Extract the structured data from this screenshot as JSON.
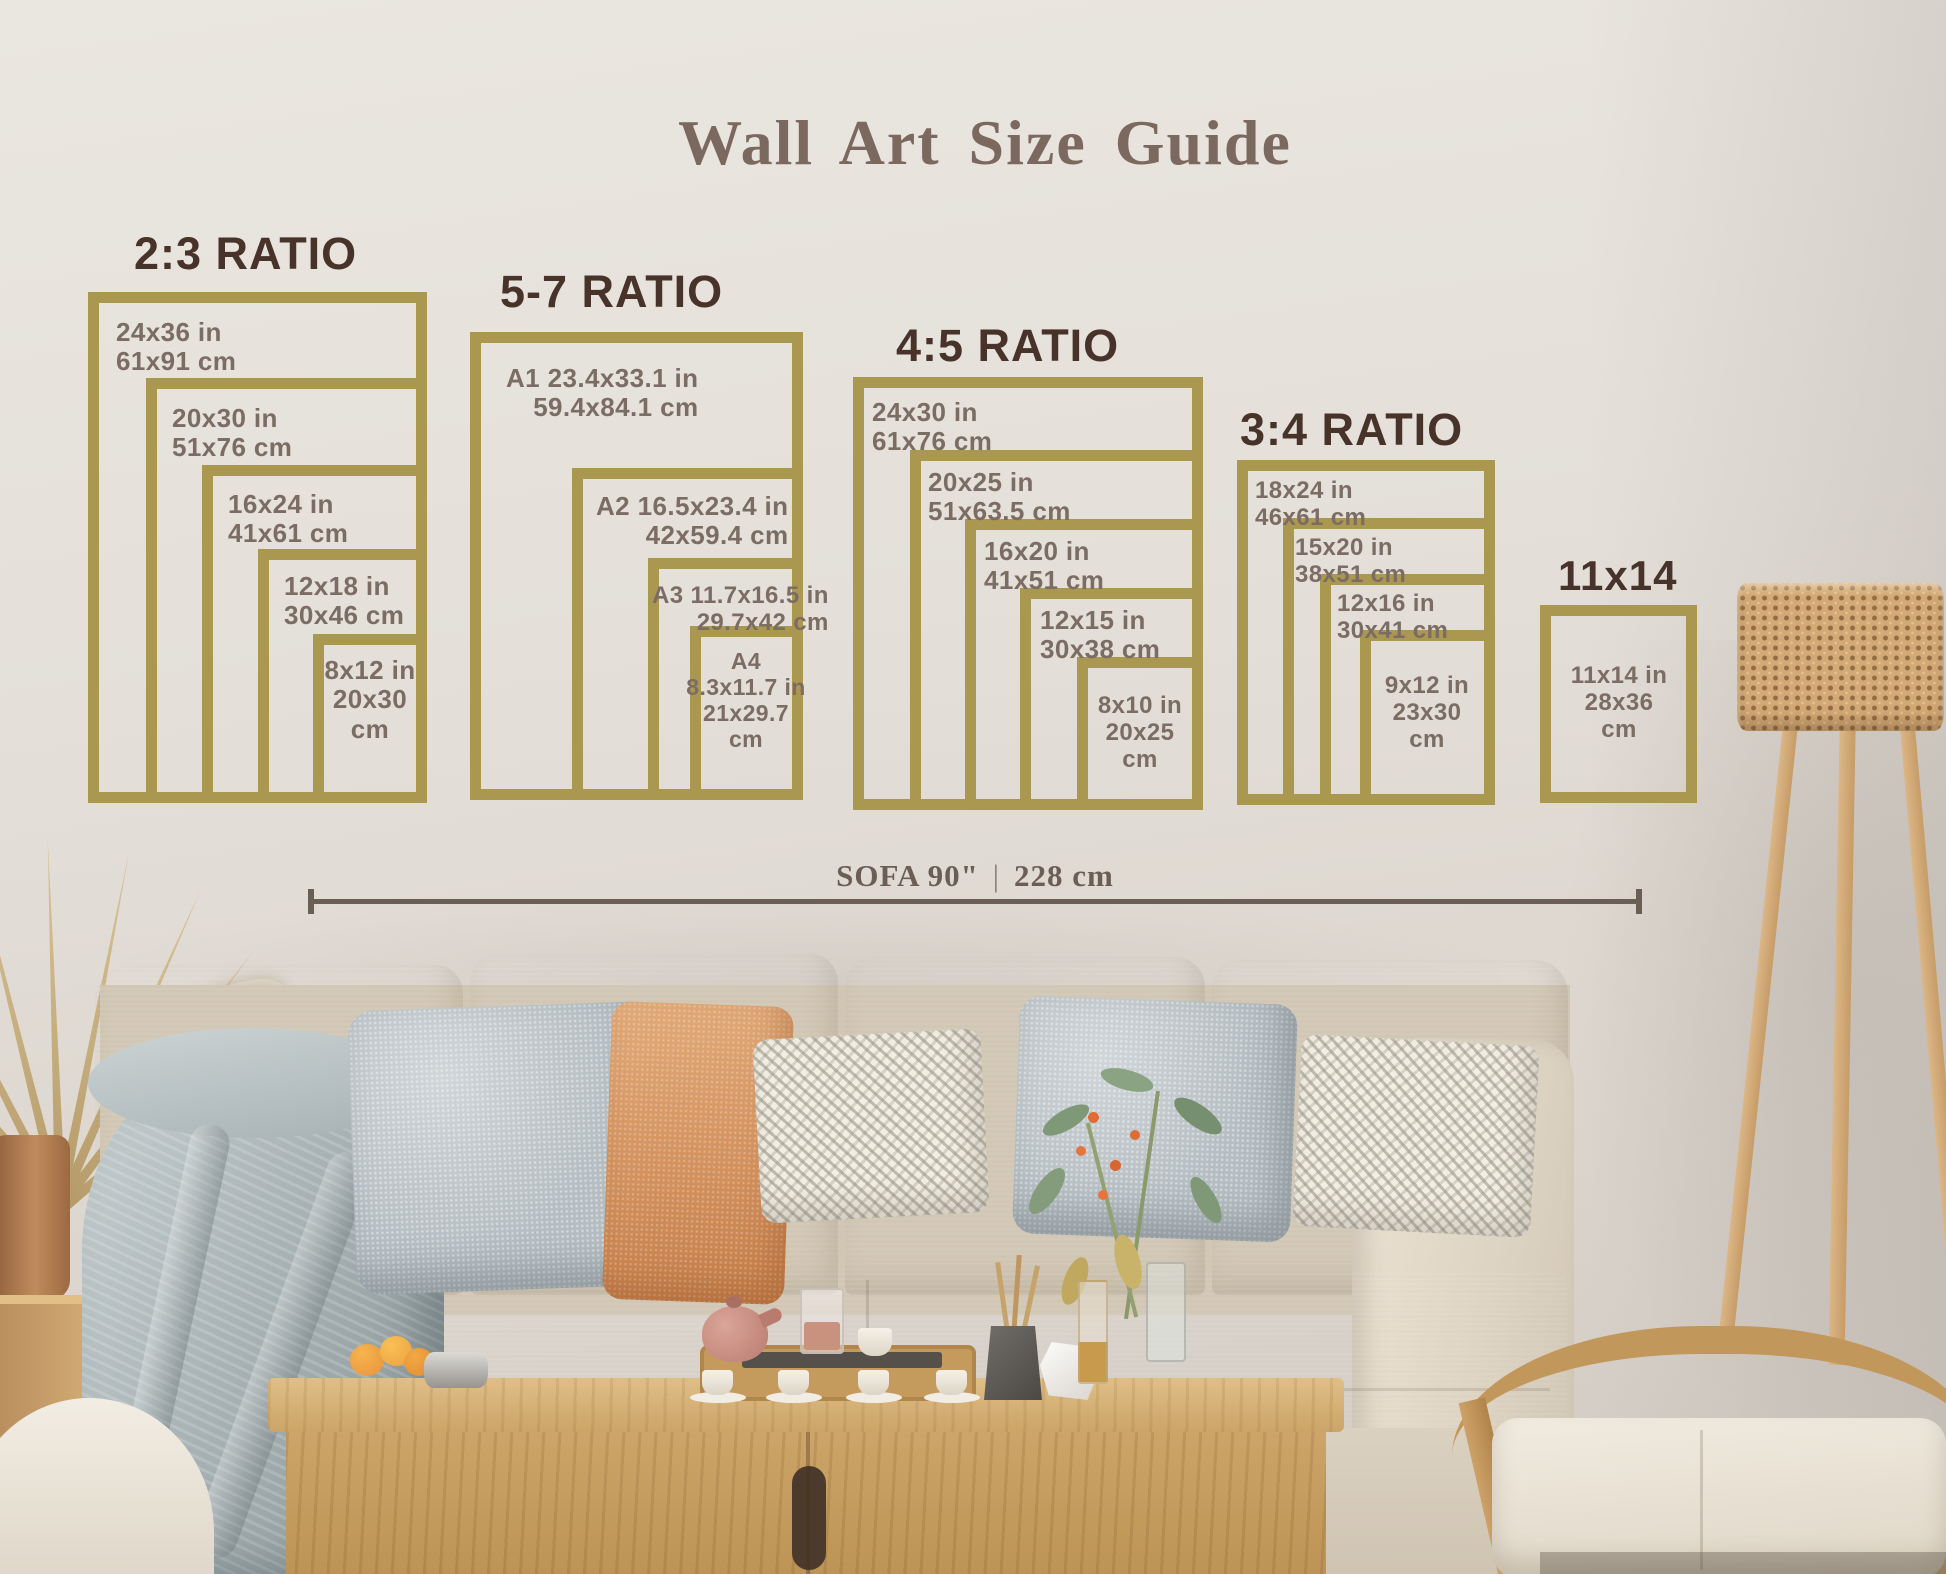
{
  "title": "Wall Art Size Guide",
  "sections": [
    {
      "heading": "2:3 RATIO",
      "sizes": [
        "24x36 in\n61x91 cm",
        "20x30 in\n51x76 cm",
        "16x24 in\n41x61 cm",
        "12x18 in\n30x46 cm",
        "8x12 in\n20x30\ncm"
      ]
    },
    {
      "heading": "5-7 RATIO",
      "sizes": [
        "A1 23.4x33.1 in\n59.4x84.1 cm",
        "A2 16.5x23.4 in\n42x59.4 cm",
        "A3 11.7x16.5 in\n29.7x42 cm",
        "A4\n8.3x11.7 in\n21x29.7\ncm"
      ]
    },
    {
      "heading": "4:5 RATIO",
      "sizes": [
        "24x30 in\n61x76 cm",
        "20x25 in\n51x63.5 cm",
        "16x20 in\n41x51 cm",
        "12x15 in\n30x38 cm",
        "8x10 in\n20x25\ncm"
      ]
    },
    {
      "heading": "3:4 RATIO",
      "sizes": [
        "18x24 in\n46x61 cm",
        "15x20 in\n38x51 cm",
        "12x16 in\n30x41 cm",
        "9x12 in\n23x30\ncm"
      ]
    },
    {
      "heading": "11x14",
      "sizes": [
        "11x14 in\n28x36\ncm"
      ]
    }
  ],
  "measure": {
    "left": "SOFA 90\"",
    "separator": "|",
    "right": "228 cm"
  },
  "colors": {
    "frame_gold": "#ab9850",
    "heading_brown": "#48332a",
    "label_gray": "#7b6d63",
    "title_brown": "#7b685e",
    "measure_taupe": "#6b5e55",
    "accent_terracotta": "#d7976a"
  }
}
